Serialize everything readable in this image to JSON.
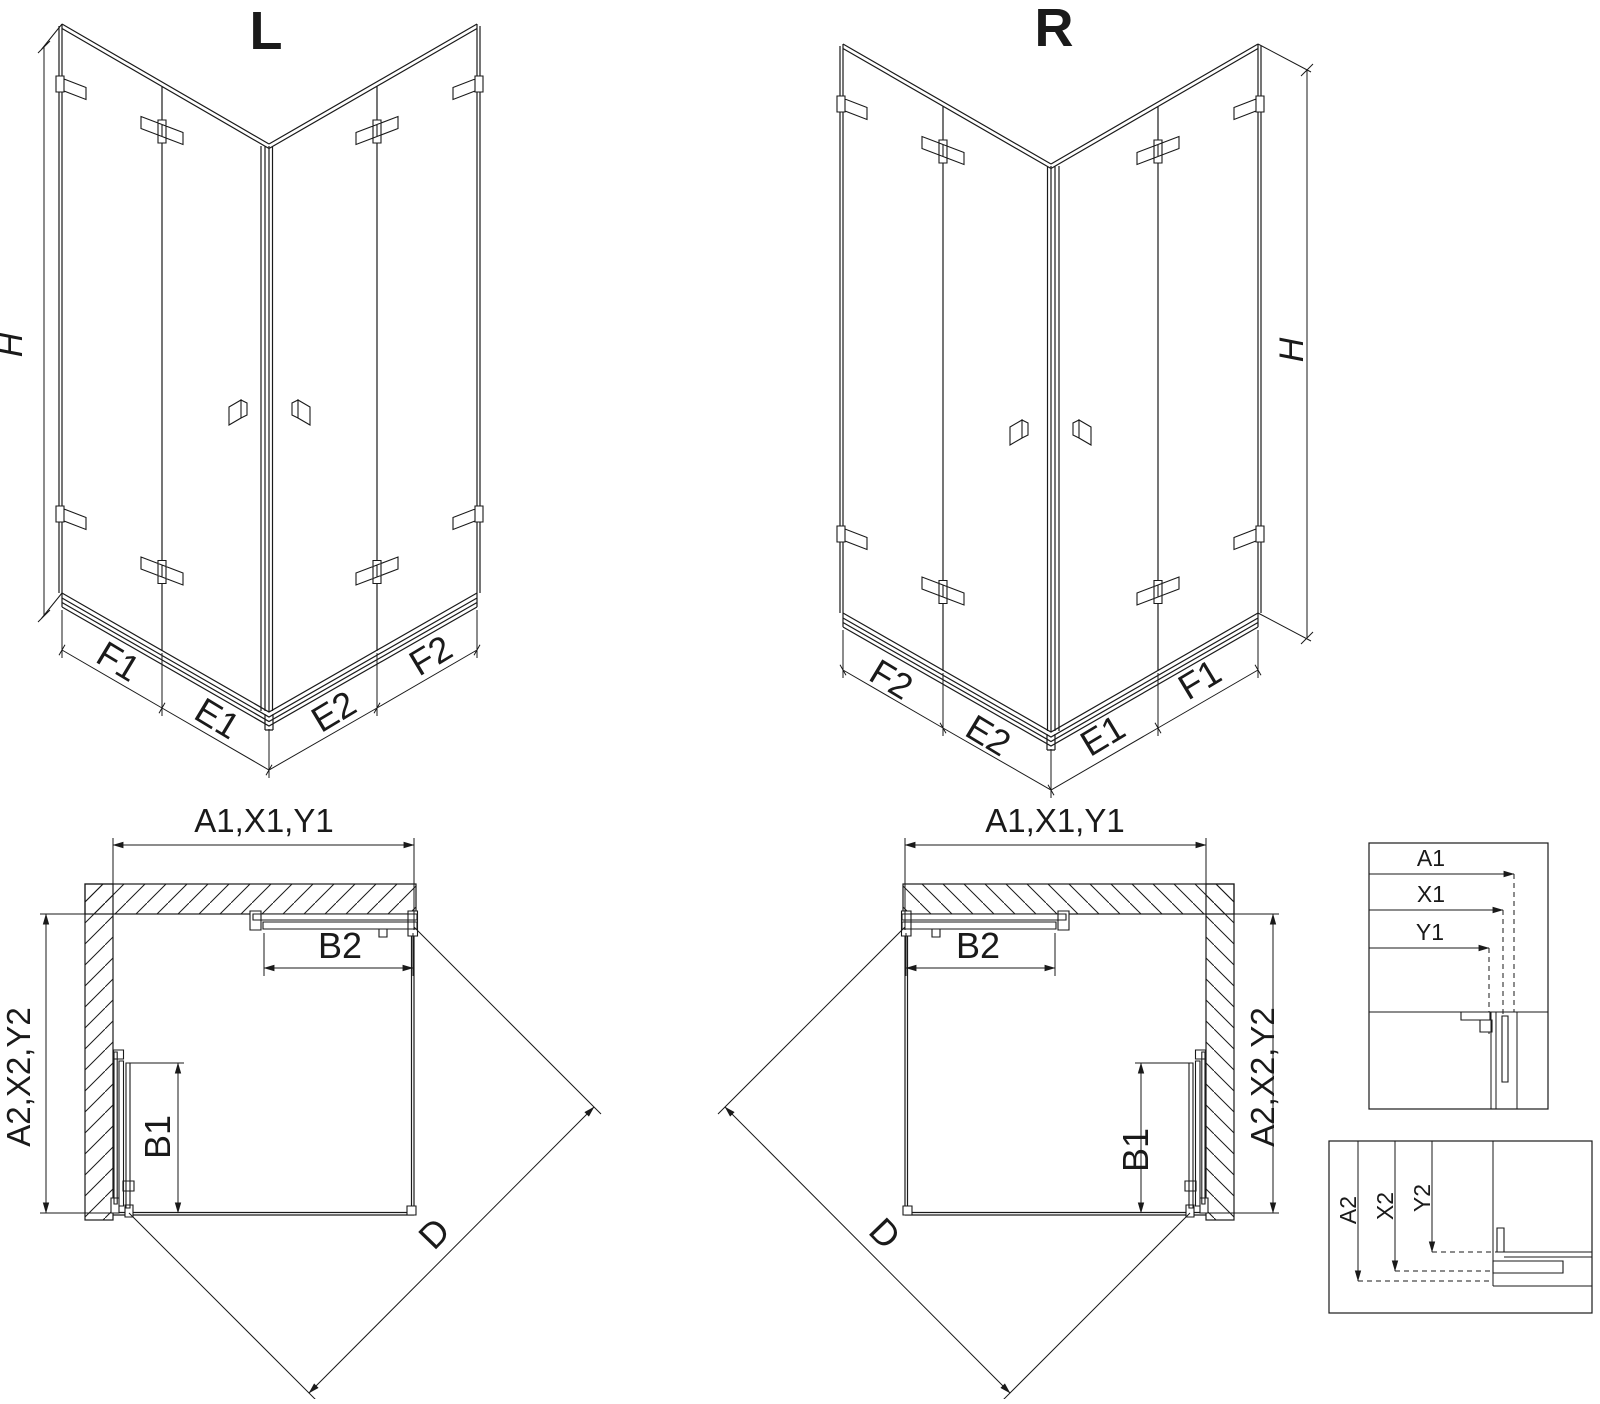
{
  "colors": {
    "line": "#1a1a1a",
    "background": "#ffffff"
  },
  "iso_left": {
    "title": "L",
    "height_dim": "H",
    "bottom_dims": [
      "F1",
      "E1",
      "E2",
      "F2"
    ]
  },
  "iso_right": {
    "title": "R",
    "height_dim": "H",
    "bottom_dims": [
      "F2",
      "E2",
      "E1",
      "F1"
    ]
  },
  "plan_left": {
    "width_dim": "A1,X1,Y1",
    "depth_dim": "A2,X2,Y2",
    "door_top_dim": "B2",
    "door_side_dim": "B1",
    "diagonal_dim": "D"
  },
  "plan_right": {
    "width_dim": "A1,X1,Y1",
    "depth_dim": "A2,X2,Y2",
    "door_top_dim": "B2",
    "door_side_dim": "B1",
    "diagonal_dim": "D"
  },
  "detail_top": {
    "dims": [
      "A1",
      "X1",
      "Y1"
    ]
  },
  "detail_bottom": {
    "dims": [
      "A2",
      "X2",
      "Y2"
    ]
  }
}
